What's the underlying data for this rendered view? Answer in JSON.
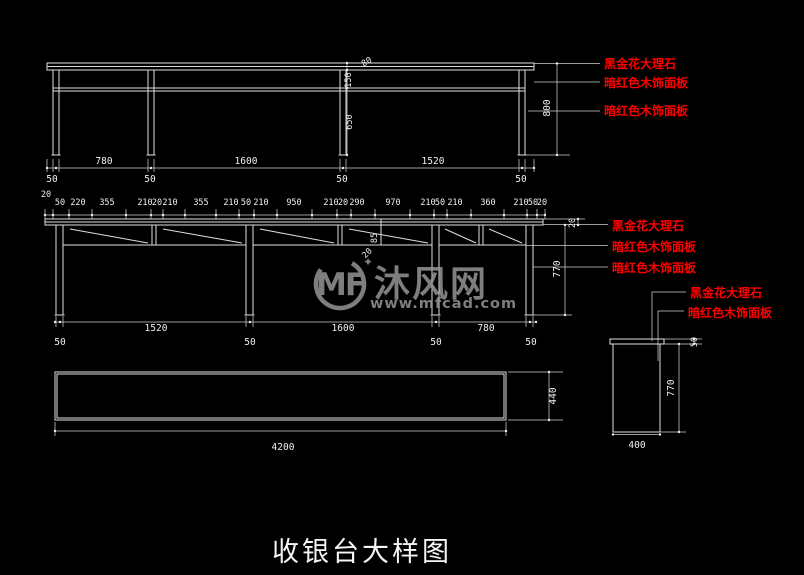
{
  "title": "收银台大样图",
  "colors": {
    "background": "#000000",
    "line": "#dfdfdf",
    "dim_text": "#f0f0f0",
    "callout_red": "#ff0000",
    "watermark_gray": "#9a9a9a",
    "title_white": "#f5f5f5"
  },
  "watermark": {
    "logo_text": "MF",
    "sparkle": "✦",
    "brand": "沐风网",
    "url": "www.mfcad.com"
  },
  "front_elevation": {
    "span_dims": [
      "780",
      "1600",
      "1520"
    ],
    "leg_dims": [
      "50",
      "50",
      "50",
      "50"
    ],
    "overall_height": "800",
    "top_thickness": "80",
    "apron_height": "150",
    "leg_height": "650",
    "callouts": [
      "黑金花大理石",
      "暗红色木饰面板",
      "暗红色木饰面板"
    ]
  },
  "counter_elevation": {
    "top_chain": [
      "20",
      "50",
      "220",
      "355",
      "210",
      "20",
      "210",
      "355",
      "210",
      "50",
      "210",
      "950",
      "210",
      "20",
      "290",
      "970",
      "210",
      "50",
      "210",
      "360",
      "210",
      "50",
      "20"
    ],
    "shelf_depth": "85",
    "shelf_edge": "20",
    "top_thickness": "20",
    "body_height": "770",
    "span_dims": [
      "1520",
      "1600",
      "780"
    ],
    "leg_dims": [
      "50",
      "50",
      "50",
      "50"
    ],
    "callouts": [
      "黑金花大理石",
      "暗红色木饰面板",
      "暗红色木饰面板"
    ]
  },
  "plan_view": {
    "length": "4200",
    "depth": "440"
  },
  "side_section": {
    "top_thickness": "50",
    "height": "770",
    "width": "400",
    "callouts": [
      "黑金花大理石",
      "暗红色木饰面板"
    ]
  }
}
